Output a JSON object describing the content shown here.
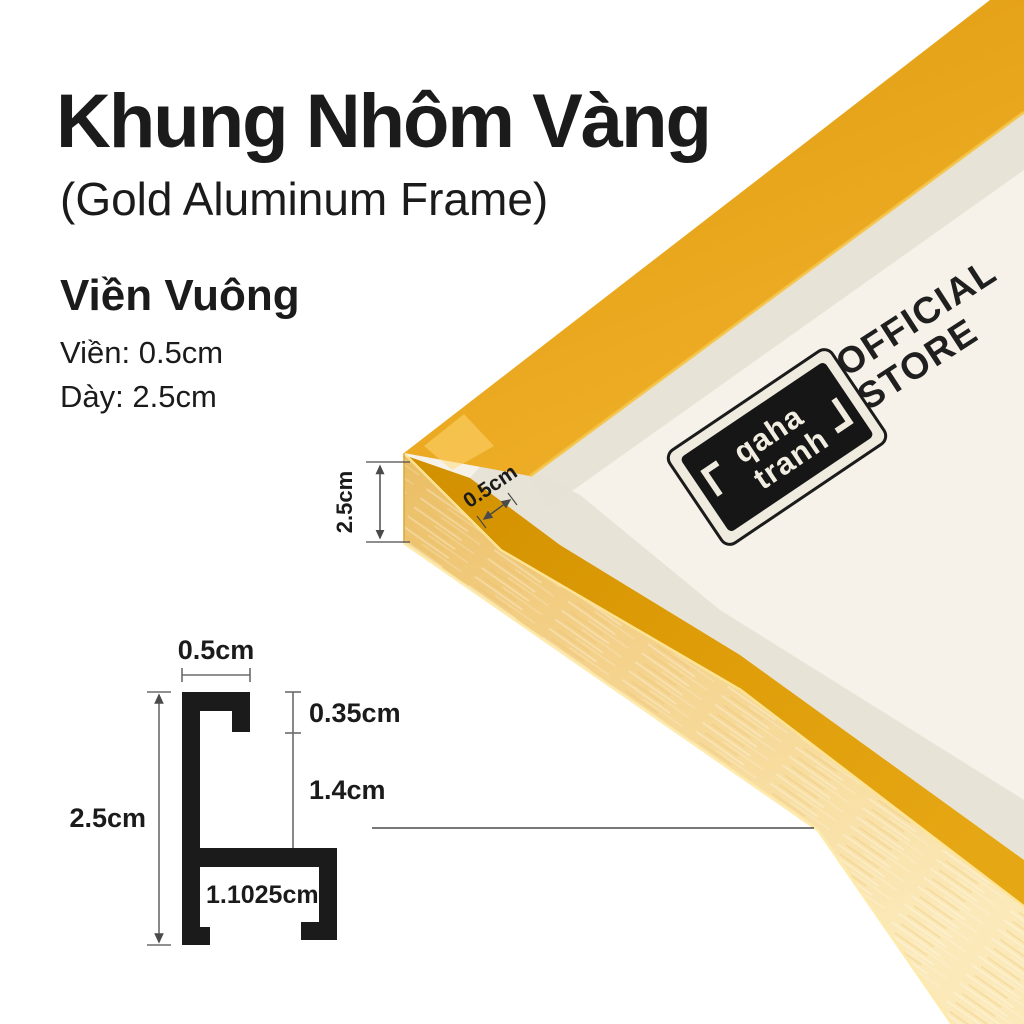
{
  "colors": {
    "ink": "#1b1b1b",
    "dim_line": "#5a5a5a",
    "gold_dark": "#d79201",
    "gold_mid": "#e8a61c",
    "gold_light": "#f3cf86",
    "gold_highlight": "#ffe79b",
    "backing_cream": "#f6f2e9",
    "mat_shadow": "#e6e1d5",
    "badge_black": "#161616",
    "badge_cream": "#f0ebdf"
  },
  "header": {
    "title": "Khung Nhôm Vàng",
    "subtitle": "(Gold Aluminum Frame)"
  },
  "specs": {
    "heading": "Viền Vuông",
    "border_label": "Viền: 0.5cm",
    "depth_label": "Dày: 2.5cm"
  },
  "photo": {
    "official_store": {
      "line1": "OFFICIAL",
      "line2": "STORE"
    },
    "badge": {
      "word1": "qaha",
      "word2": "tranh"
    },
    "dim_thickness": "2.5cm",
    "dim_face": "0.5cm"
  },
  "profile_diagram": {
    "dim_top": "0.5cm",
    "dim_height": "2.5cm",
    "dim_lip": "0.35cm",
    "dim_wall": "1.4cm",
    "dim_base": "1.1025cm"
  }
}
